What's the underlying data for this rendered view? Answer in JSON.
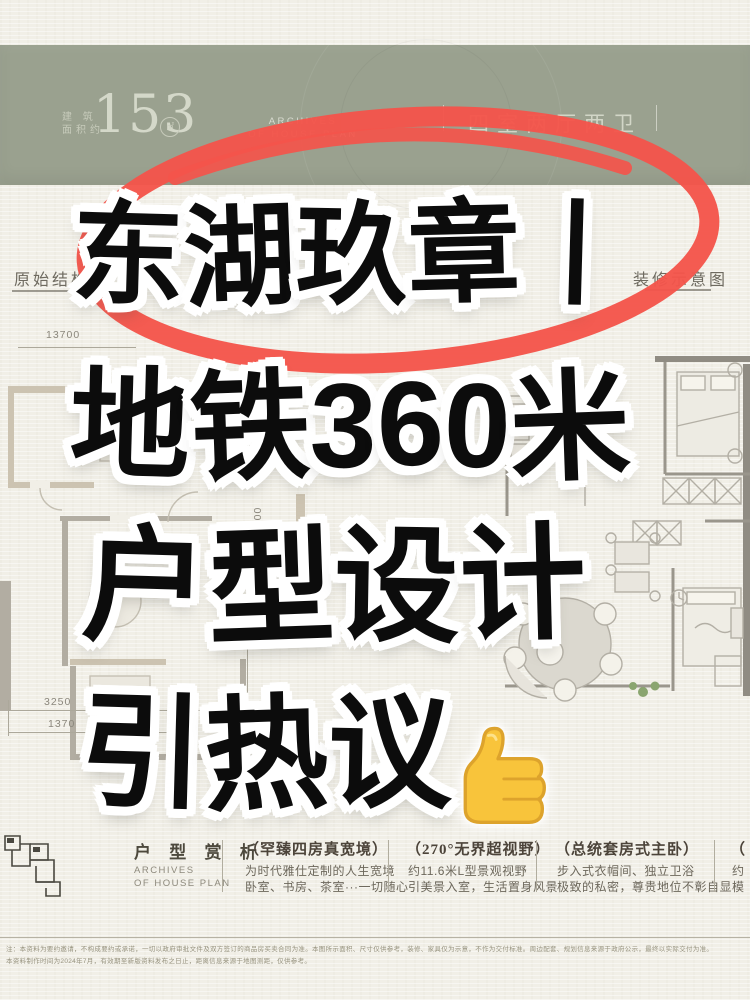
{
  "colors": {
    "paper": "#f1efe7",
    "band_green": "#9aa18f",
    "marker_red": "#f4544b",
    "headline_ink": "#0c0c0c",
    "plan_line": "#a6a196",
    "emoji_yellow": "#f8c43b"
  },
  "band": {
    "area_label_line1": "建 筑",
    "area_label_line2": "面积约",
    "area_value": "153",
    "area_unit": "㎡",
    "archives_line1": "ARCHIVES",
    "archives_line2": "OF HOUSE PLAN",
    "layout_label": "四室两厅两卫"
  },
  "plan": {
    "left_label": "原始结构图",
    "right_label": "装修示意图",
    "dim_top": "13700",
    "dim_right": "3000",
    "dim_bottom_1": "3250",
    "dim_bottom_2": "1370"
  },
  "headline": {
    "line1": "东湖玖章丨",
    "line2": "地铁360米",
    "line3": "户型设计",
    "line4": "引热议",
    "emoji": "thumbs-up"
  },
  "footer": {
    "section_title": "户 型 赏 析",
    "section_sub_line1": "ARCHIVES",
    "section_sub_line2": "OF HOUSE PLAN",
    "columns": [
      {
        "title": "（罕臻四房真宽境）",
        "line1": "为时代雅仕定制的人生宽境",
        "line2": "卧室、书房、茶室···一切随心"
      },
      {
        "title": "（270°无界超视野）",
        "line1": "约11.6米L型景观视野",
        "line2": "引美景入室，生活置身风景"
      },
      {
        "title": "（总统套房式主卧）",
        "line1": "步入式衣帽间、独立卫浴",
        "line2": "极致的私密，尊贵地位不彰自显"
      },
      {
        "title": "（",
        "line1": "约",
        "line2": "模"
      }
    ],
    "disclaimer_line1": "注：本资料为要约邀请，不构成要约或承诺，一切以政府审批文件及双方签订的商品房买卖合同为准。本图所示面积、尺寸仅供参考，装修、家具仅为示意，不作为交付标准。周边配套、规划信息来源于政府公示，最终以实际交付为准。",
    "disclaimer_line2": "本资料制作时间为2024年7月，有效期至新版资料发布之日止，距离信息来源于地图测距，仅供参考。"
  }
}
